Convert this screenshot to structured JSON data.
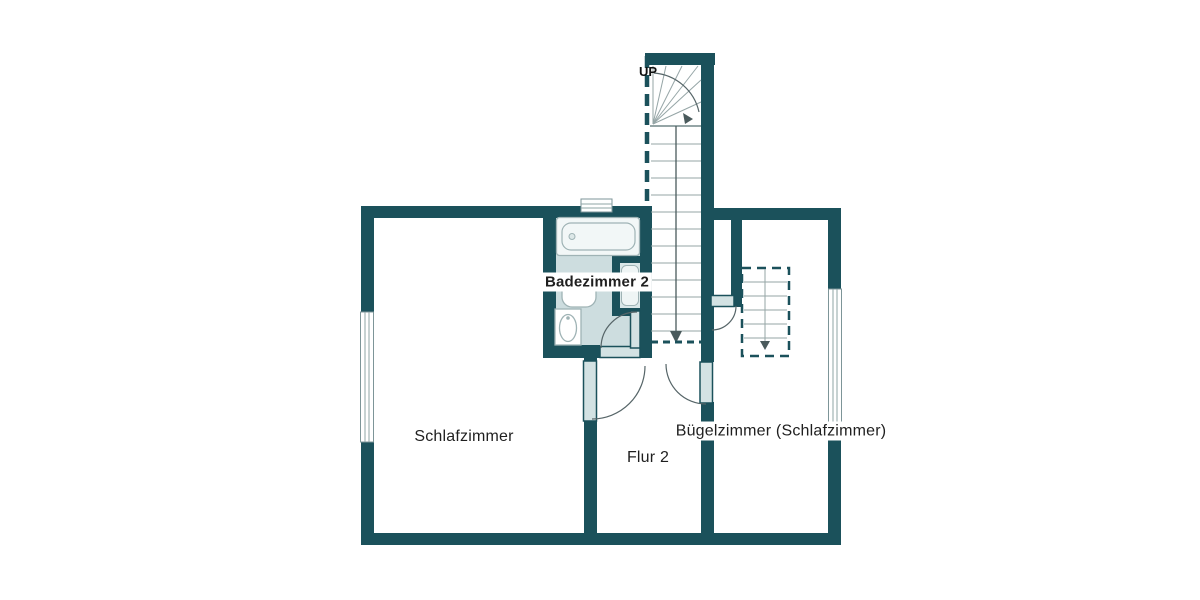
{
  "plan": {
    "labels": {
      "bedroom": "Schlafzimmer",
      "hallway": "Flur 2",
      "bathroom": "Badezimmer 2",
      "ironing_room": "Bügelzimmer (Schlafzimmer)",
      "stairs_up": "UP"
    },
    "colors": {
      "wall": "#1b515b",
      "bath_floor": "#cddddf",
      "fixture_fill": "#d3e2e3",
      "line": "#95a5a6",
      "text": "#1f1f1f",
      "background": "#ffffff"
    }
  }
}
